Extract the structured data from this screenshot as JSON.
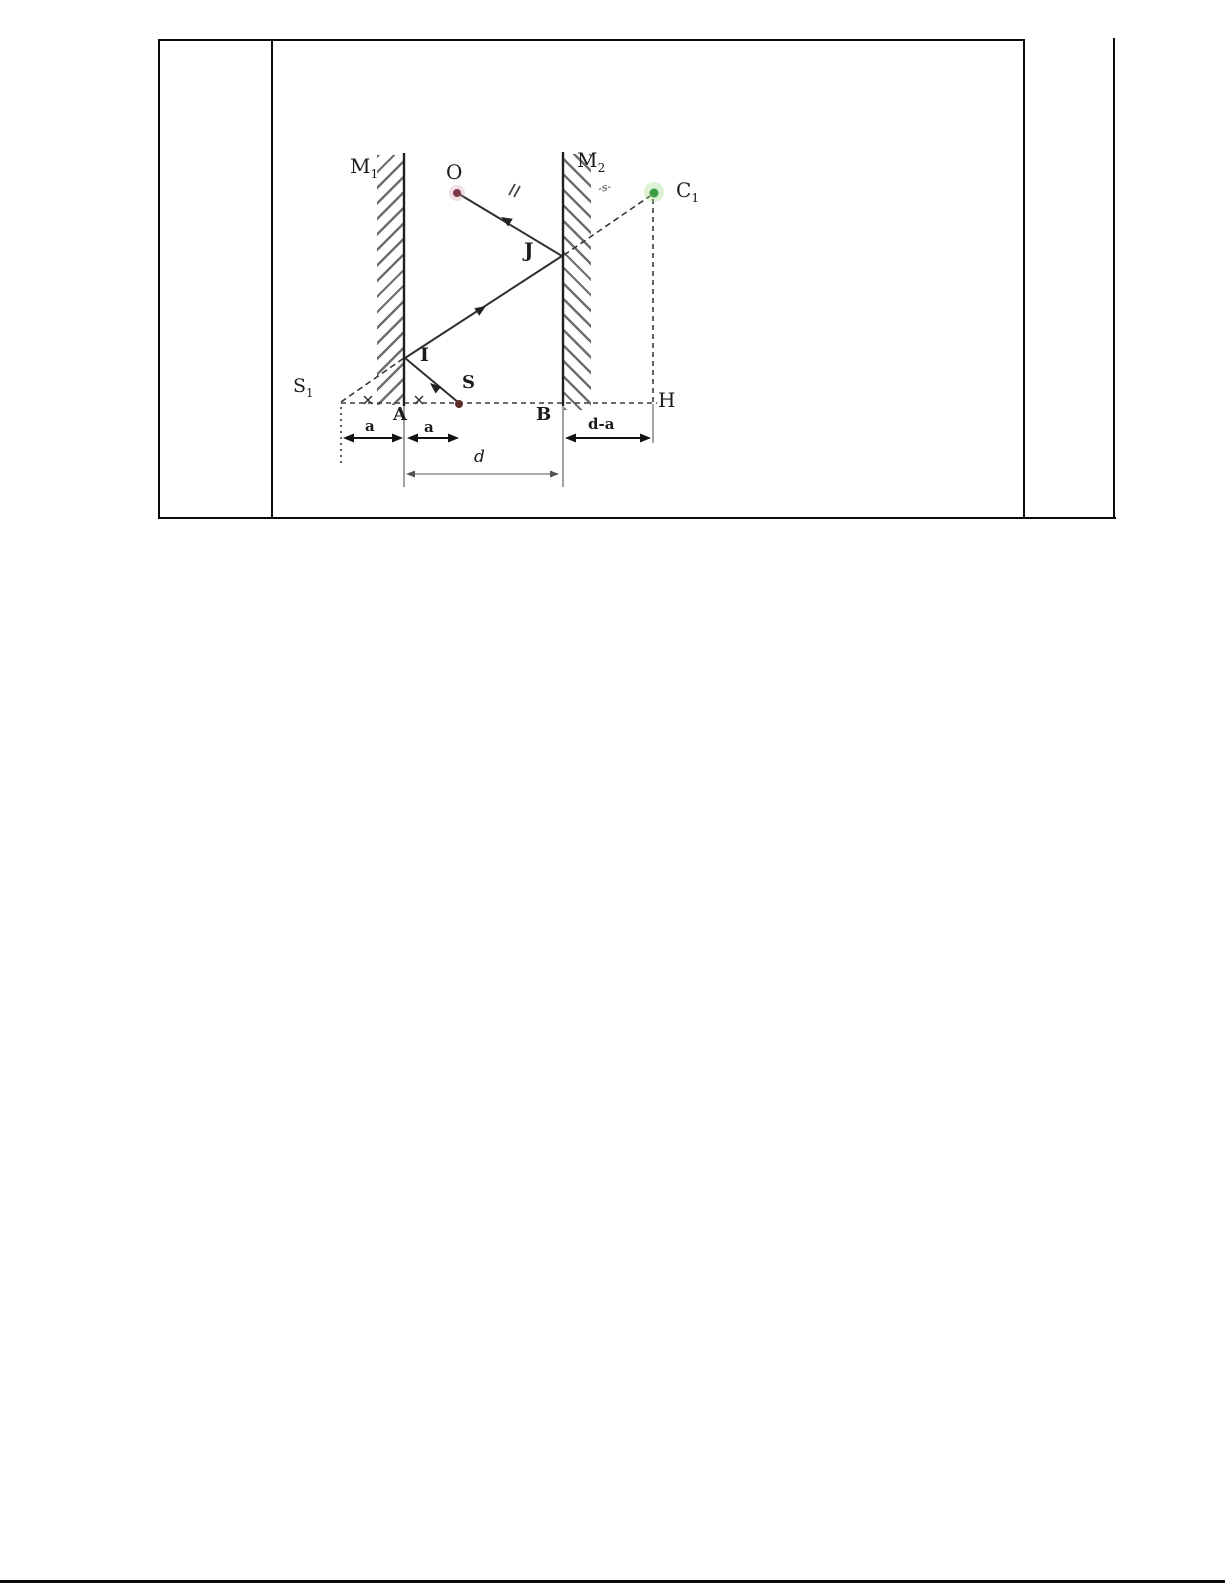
{
  "diagram": {
    "mirrors": {
      "m1": {
        "base": "M",
        "sub": "1"
      },
      "m2": {
        "base": "M",
        "sub": "2"
      }
    },
    "points": {
      "o": "O",
      "c1": {
        "base": "C",
        "sub": "1"
      },
      "j": "J",
      "i": "I",
      "s": "S",
      "s1": {
        "base": "S",
        "sub": "1"
      },
      "a": "A",
      "b": "B",
      "h": "H"
    },
    "dimensions": {
      "a_left": "a",
      "a_right": "a",
      "d_minus_a": "d-a",
      "d": "d"
    },
    "marks": {
      "ray_mark": "-s-"
    },
    "colors": {
      "source_dot": "#5e2b2b",
      "object_dot": "#7c3a46",
      "image_dot_green": "#3e9c43",
      "line": "#2f2f2f"
    }
  }
}
